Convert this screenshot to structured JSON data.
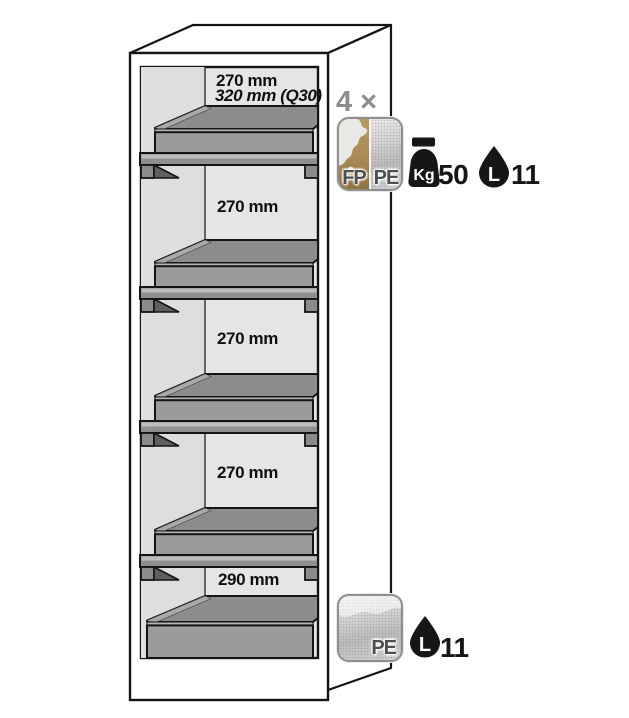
{
  "cabinet": {
    "compartments": [
      {
        "line1": "270 mm",
        "line2": "320 mm (Q30)"
      },
      {
        "line1": "270 mm"
      },
      {
        "line1": "270 mm"
      },
      {
        "line1": "270 mm"
      },
      {
        "line1": "290 mm"
      }
    ]
  },
  "shelf_annotation": {
    "count_label": "4 ×",
    "material_left": "FP",
    "material_right": "PE",
    "load_unit": "Kg",
    "load_value": "50",
    "volume_unit": "L",
    "volume_value": "11"
  },
  "sump_annotation": {
    "material": "PE",
    "volume_unit": "L",
    "volume_value": "11"
  },
  "colors": {
    "outline": "#141414",
    "back_wall_gray": "#e5e5e5",
    "side_wall_gray": "#dedede",
    "tray_interior_gray": "#8c8c8c",
    "tray_front_gray": "#9b9b9b",
    "shelf_board_gray": "#8f8f8f",
    "fp_gold": "#a88a54",
    "pe_gray": "#c9c9c9",
    "count_label_gray": "#8d8d8d",
    "icon_black": "#161616"
  }
}
